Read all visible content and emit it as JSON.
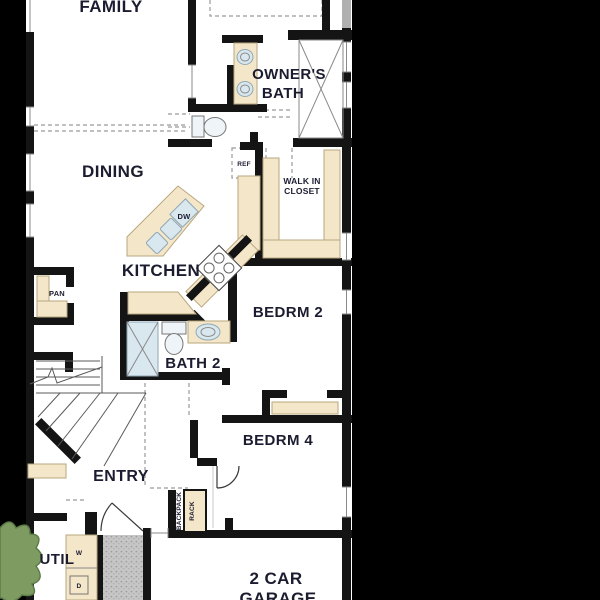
{
  "rooms": {
    "family": "FAMILY",
    "dining": "DINING",
    "kitchen": "KITCHEN",
    "owners_bath_1": "OWNER'S",
    "owners_bath_2": "BATH",
    "walk_in_1": "WALK IN",
    "walk_in_2": "CLOSET",
    "bedrm2": "BEDRM 2",
    "bath2": "BATH 2",
    "bedrm4": "BEDRM 4",
    "entry": "ENTRY",
    "util": "UTIL",
    "pan": "PAN",
    "garage_1": "2 CAR",
    "garage_2": "GARAGE"
  },
  "fixtures": {
    "ref": "REF",
    "dw": "DW",
    "washer": "W",
    "dryer": "D",
    "backpack": "BACKPACK",
    "rack": "RACK"
  },
  "colors": {
    "background": "#000000",
    "floor": "#ffffff",
    "wall": "#141414",
    "counter": "#f4e7c9",
    "counter_edge": "#b9a77f",
    "fixture_fill": "#d9e7ef",
    "fixture_edge": "#8fa6b5",
    "porch": "#c6c6c6",
    "shrub": "#7e9c62",
    "dashed_line": "#9a9a9a",
    "text": "#1c1c30"
  }
}
